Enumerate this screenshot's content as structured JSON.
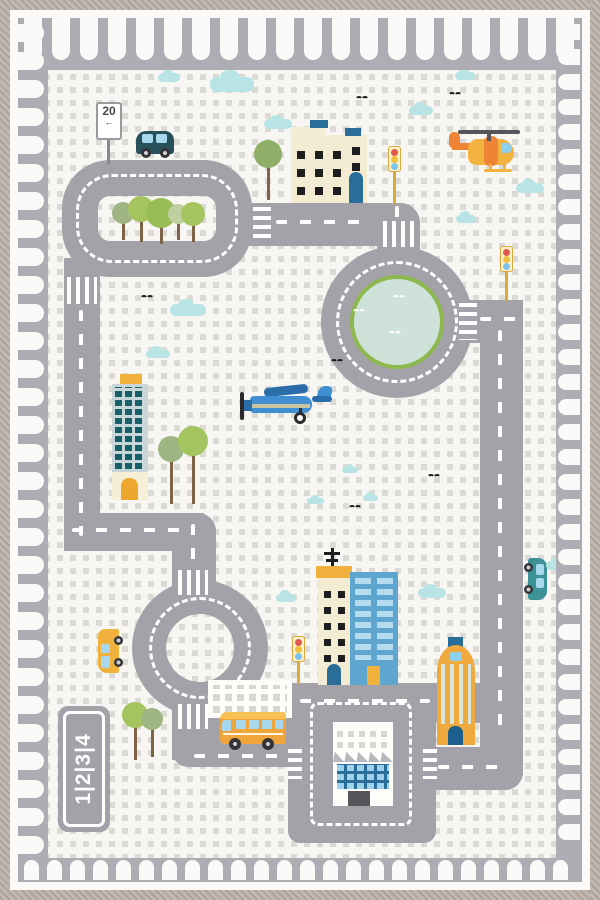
{
  "scene": {
    "description": "children's city road play rug, top-down toy traffic map",
    "signs": {
      "speed_limit": "20",
      "speed_arrow": "←",
      "lane_numbers": "1|2|3|4"
    },
    "colors": {
      "road": "#a3a2a8",
      "band": "#aeadb3",
      "bg": "#f7f6f2",
      "dot": "#dbdad5",
      "tab": "#fbfaf8",
      "frame-a": "#b9b0aa",
      "frame-b": "#a29892",
      "frame-c": "#c4bbb4",
      "pond": "#cfe2d9",
      "pond-rim": "#8cb84e",
      "cloud": "#b9e4e6",
      "bird": "#1c1c1e",
      "cream": "#f3ecd3",
      "window-dark": "#1e1e20",
      "blue-accent": "#2a6d99",
      "sky-body": "#c7d6d8",
      "sky-win": "#17606a",
      "cap-yellow": "#f0b23c",
      "base-cream": "#f6eed6",
      "door-orange": "#eca82e",
      "blue-bldg": "#5ea6cf",
      "blue-bldg-win": "#b5dcee",
      "white-bldg": "#fdfdfa",
      "white-bldg-win": "#d8d8d3",
      "roof-gray": "#b9b9bf",
      "factory-win": "#9ed2ec",
      "factory-frame": "#2a6d99",
      "dome-yellow": "#f0a93c",
      "dome-stripe": "#d8e5d8",
      "heli-yellow": "#f3b340",
      "heli-orange": "#ee8435",
      "heli-win": "#8fd0ee",
      "rotor": "#55555a",
      "plane-blue": "#3f8fd2",
      "plane-dark": "#2a6da8",
      "plane-stripe": "#c9c3a0",
      "suv": "#27505a",
      "car-teal": "#3d9296",
      "bus-orange": "#f0a43c",
      "bus-roof": "#f6c054",
      "van-yellow": "#f0b23c",
      "veh-win": "#a8d8ee",
      "wheel": "#333338",
      "tl-red": "#e2574c",
      "tl-yellow": "#f0c03c",
      "tl-blue": "#7cc3e8",
      "tl-box": "#fdf0cc",
      "tl-pole": "#d9a93c",
      "trunk": "#7d6448",
      "sign-text": "#4a4a4e"
    },
    "border": {
      "tabs": [
        {
          "side": "top",
          "from": 24,
          "max": 582,
          "size": 18,
          "gap": 10,
          "len": 42,
          "edge": 18
        },
        {
          "side": "left",
          "from": 24,
          "max": 864,
          "size": 18,
          "gap": 10,
          "len": 26,
          "edge": 18
        },
        {
          "side": "right",
          "from": 24,
          "max": 864,
          "size": 16,
          "gap": 9,
          "len": 22,
          "edge": 558
        },
        {
          "side": "bottom",
          "from": 24,
          "max": 582,
          "size": 15,
          "gap": 8,
          "len": 20,
          "edge": 860
        }
      ]
    },
    "clouds": [
      {
        "x": 158,
        "y": 73,
        "w": 22,
        "h": 9
      },
      {
        "x": 210,
        "y": 77,
        "w": 44,
        "h": 15
      },
      {
        "x": 264,
        "y": 119,
        "w": 28,
        "h": 10
      },
      {
        "x": 409,
        "y": 106,
        "w": 24,
        "h": 9
      },
      {
        "x": 455,
        "y": 72,
        "w": 20,
        "h": 8
      },
      {
        "x": 516,
        "y": 183,
        "w": 28,
        "h": 10
      },
      {
        "x": 456,
        "y": 215,
        "w": 20,
        "h": 8
      },
      {
        "x": 170,
        "y": 304,
        "w": 36,
        "h": 12
      },
      {
        "x": 146,
        "y": 350,
        "w": 24,
        "h": 8
      },
      {
        "x": 307,
        "y": 498,
        "w": 17,
        "h": 6
      },
      {
        "x": 342,
        "y": 467,
        "w": 16,
        "h": 6
      },
      {
        "x": 363,
        "y": 495,
        "w": 15,
        "h": 6
      },
      {
        "x": 276,
        "y": 594,
        "w": 20,
        "h": 8
      },
      {
        "x": 418,
        "y": 588,
        "w": 28,
        "h": 10
      },
      {
        "x": 546,
        "y": 561,
        "w": 22,
        "h": 9
      }
    ],
    "birds": [
      {
        "x": 355,
        "y": 96,
        "c": "#1c1c1e"
      },
      {
        "x": 448,
        "y": 92,
        "c": "#1c1c1e"
      },
      {
        "x": 140,
        "y": 295,
        "c": "#1c1c1e"
      },
      {
        "x": 330,
        "y": 359,
        "c": "#1c1c1e"
      },
      {
        "x": 348,
        "y": 505,
        "c": "#1c1c1e"
      },
      {
        "x": 427,
        "y": 474,
        "c": "#1c1c1e"
      }
    ],
    "pond_birds": [
      {
        "x": 392,
        "y": 295,
        "c": "#ffffff"
      },
      {
        "x": 352,
        "y": 309,
        "c": "#ffffff"
      },
      {
        "x": 388,
        "y": 331,
        "c": "#ffffff"
      }
    ],
    "trees": [
      {
        "x": 112,
        "y": 202,
        "d": 22,
        "c": "#9fb483",
        "t": 240
      },
      {
        "x": 128,
        "y": 196,
        "d": 26,
        "c": "#a4c45f",
        "t": 242
      },
      {
        "x": 146,
        "y": 198,
        "d": 30,
        "c": "#97bd56",
        "t": 244
      },
      {
        "x": 168,
        "y": 204,
        "d": 20,
        "c": "#c0cfa0",
        "t": 240
      },
      {
        "x": 181,
        "y": 202,
        "d": 24,
        "c": "#a4c45f",
        "t": 242
      },
      {
        "x": 254,
        "y": 140,
        "d": 28,
        "c": "#8fae67",
        "t": 200
      },
      {
        "x": 158,
        "y": 436,
        "d": 26,
        "c": "#9fb483",
        "t": 504
      },
      {
        "x": 178,
        "y": 426,
        "d": 30,
        "c": "#a4c45f",
        "t": 504
      },
      {
        "x": 122,
        "y": 702,
        "d": 26,
        "c": "#a4c45f",
        "t": 760
      },
      {
        "x": 141,
        "y": 708,
        "d": 22,
        "c": "#9fb483",
        "t": 757
      }
    ],
    "road_dashes": [
      {
        "dir": "h",
        "x": 276,
        "y": 220,
        "len": 86
      },
      {
        "dir": "v",
        "x": 395,
        "y": 206,
        "len": 13
      },
      {
        "dir": "h",
        "x": 480,
        "y": 317,
        "len": 36
      },
      {
        "dir": "v",
        "x": 498,
        "y": 330,
        "len": 404
      },
      {
        "dir": "h",
        "x": 438,
        "y": 765,
        "len": 72
      },
      {
        "dir": "h",
        "x": 72,
        "y": 528,
        "len": 110
      },
      {
        "dir": "v",
        "x": 79,
        "y": 310,
        "len": 226
      },
      {
        "dir": "v",
        "x": 191,
        "y": 524,
        "len": 46
      },
      {
        "dir": "h",
        "x": 300,
        "y": 699,
        "len": 130
      },
      {
        "dir": "h",
        "x": 194,
        "y": 754,
        "len": 96
      }
    ],
    "crosswalks": [
      {
        "dir": "h",
        "x": 253,
        "y": 207,
        "w": 18,
        "h": 36
      },
      {
        "dir": "v",
        "x": 383,
        "y": 221,
        "w": 34,
        "h": 26
      },
      {
        "dir": "h",
        "x": 459,
        "y": 303,
        "w": 18,
        "h": 37
      },
      {
        "dir": "v",
        "x": 67,
        "y": 277,
        "w": 30,
        "h": 27
      },
      {
        "dir": "v",
        "x": 178,
        "y": 570,
        "w": 30,
        "h": 25
      },
      {
        "dir": "v",
        "x": 178,
        "y": 704,
        "w": 30,
        "h": 25
      },
      {
        "dir": "h",
        "x": 288,
        "y": 749,
        "w": 14,
        "h": 30
      },
      {
        "dir": "h",
        "x": 423,
        "y": 749,
        "w": 14,
        "h": 30
      }
    ]
  }
}
